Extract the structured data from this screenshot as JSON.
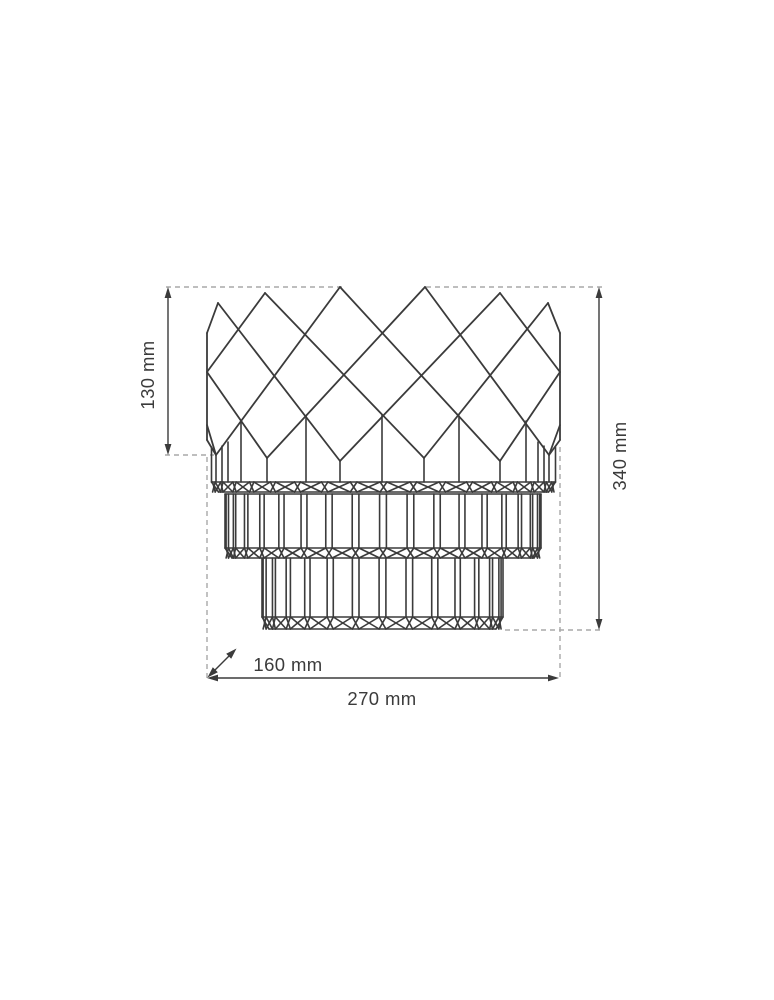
{
  "diagram": {
    "type": "technical-dimension-drawing",
    "subject": "three-tier crystal wall lamp, front elevation with dimension lines",
    "dimensions": {
      "crown_height": {
        "label": "130 mm",
        "orientation": "vertical-left"
      },
      "total_height": {
        "label": "340 mm",
        "orientation": "vertical-right"
      },
      "depth": {
        "label": "160 mm",
        "orientation": "diagonal"
      },
      "width": {
        "label": "270 mm",
        "orientation": "horizontal-bottom"
      }
    },
    "colors": {
      "line": "#3b3b3b",
      "dashed": "#a8a8a8",
      "text": "#3b3b3b",
      "background": "#ffffff"
    }
  }
}
